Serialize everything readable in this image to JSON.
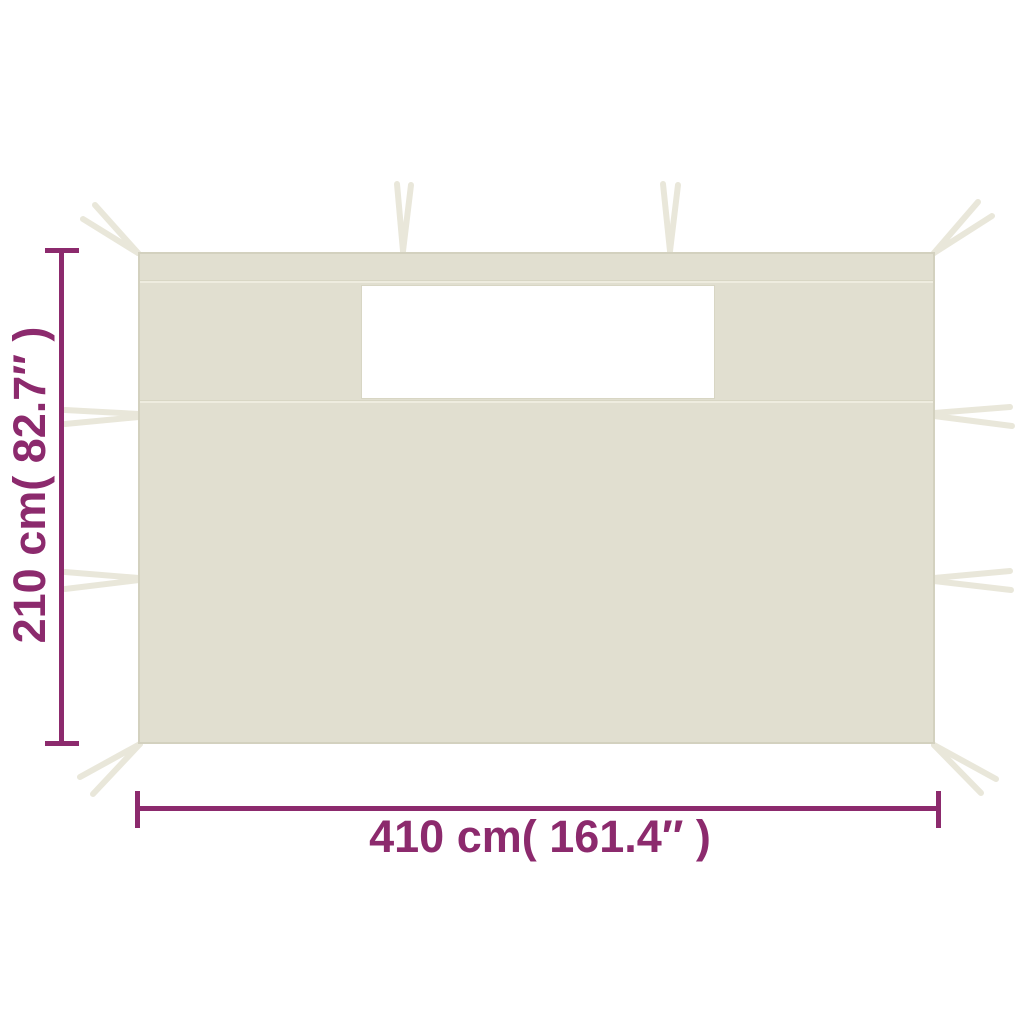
{
  "diagram": {
    "description": "Gazebo sidewall panel with window, dimension diagram",
    "background_color": "#ffffff",
    "accent_color": "#8c2a6d",
    "panel_color": "#e1dfd0",
    "panel_edge_color": "#d3d1bf",
    "seam_color": "#d8d6c4",
    "strap_color": "#e9e7da",
    "window_color": "#ffffff"
  },
  "dimensions": {
    "height": {
      "label": "210 cm( 82.7″ )",
      "cm": 210,
      "inches": 82.7
    },
    "width": {
      "label": "410 cm( 161.4″ )",
      "cm": 410,
      "inches": 161.4
    }
  }
}
